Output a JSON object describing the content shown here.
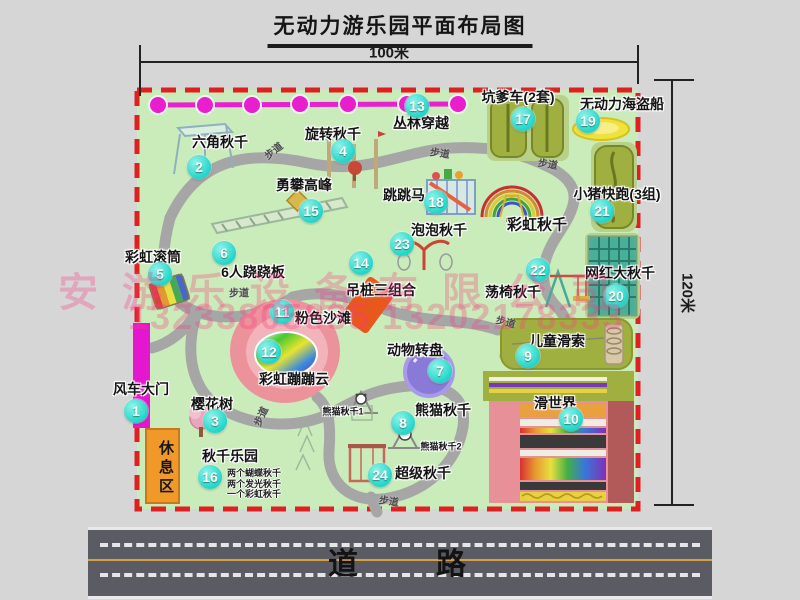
{
  "title": "无动力游乐园平面布局图",
  "dimensions": {
    "top": "100米",
    "right": "120米"
  },
  "road_label": "道　　路",
  "watermark": {
    "company": "安游乐设备有限公司",
    "phones": "13233805835 13202178333"
  },
  "rest_area_label": "休息区",
  "palette": {
    "map_green": "#c9ecba",
    "border_red": "#e02020",
    "path_gray": "#a6a6a6",
    "circle_teal": "#22d6c8",
    "gate_magenta": "#e417cf",
    "road_gray": "#5b5b63",
    "rest_orange": "#f09828",
    "watermark_pink": "#fa3c82"
  },
  "map": {
    "attractions": [
      {
        "num": "1",
        "label": "风车大门",
        "tx": 141,
        "ty": 389,
        "cx": 136,
        "cy": 411
      },
      {
        "num": "2",
        "label": "六角秋千",
        "tx": 220,
        "ty": 142,
        "cx": 199,
        "cy": 167
      },
      {
        "num": "3",
        "label": "樱花树",
        "tx": 212,
        "ty": 404,
        "cx": 215,
        "cy": 421
      },
      {
        "num": "4",
        "label": "旋转秋千",
        "tx": 333,
        "ty": 134,
        "cx": 343,
        "cy": 151
      },
      {
        "num": "5",
        "label": "彩虹滚筒",
        "tx": 153,
        "ty": 257,
        "cx": 160,
        "cy": 274
      },
      {
        "num": "6",
        "label": "6人跷跷板",
        "tx": 253,
        "ty": 272,
        "cx": 224,
        "cy": 253
      },
      {
        "num": "7",
        "label": "动物转盘",
        "tx": 415,
        "ty": 350,
        "cx": 440,
        "cy": 371
      },
      {
        "num": "8",
        "label": "熊猫秋千",
        "tx": 443,
        "ty": 410,
        "cx": 403,
        "cy": 423
      },
      {
        "num": "9",
        "label": "儿童滑索",
        "tx": 557,
        "ty": 341,
        "cx": 528,
        "cy": 356
      },
      {
        "num": "10",
        "label": "滑世界",
        "tx": 555,
        "ty": 403,
        "cx": 571,
        "cy": 419
      },
      {
        "num": "11",
        "label": "粉色沙滩",
        "tx": 323,
        "ty": 318,
        "cx": 282,
        "cy": 312
      },
      {
        "num": "12",
        "label": "彩虹蹦蹦云",
        "tx": 294,
        "ty": 379,
        "cx": 269,
        "cy": 352
      },
      {
        "num": "13",
        "label": "丛林穿越",
        "tx": 421,
        "ty": 123,
        "cx": 417,
        "cy": 106
      },
      {
        "num": "14",
        "label": "吊桩三组合",
        "tx": 381,
        "ty": 290,
        "cx": 361,
        "cy": 263
      },
      {
        "num": "15",
        "label": "勇攀高峰",
        "tx": 304,
        "ty": 185,
        "cx": 311,
        "cy": 211
      },
      {
        "num": "16",
        "label": "秋千乐园",
        "tx": 230,
        "ty": 456,
        "cx": 210,
        "cy": 477
      },
      {
        "num": "17",
        "label": "坑爹车(2套)",
        "tx": 518,
        "ty": 97,
        "cx": 523,
        "cy": 119
      },
      {
        "num": "18",
        "label": "跳跳马",
        "tx": 404,
        "ty": 195,
        "cx": 436,
        "cy": 202
      },
      {
        "num": "19",
        "label": "无动力海盗船",
        "tx": 622,
        "ty": 104,
        "cx": 588,
        "cy": 121
      },
      {
        "num": "20",
        "label": "网红大秋千",
        "tx": 620,
        "ty": 273,
        "cx": 616,
        "cy": 296
      },
      {
        "num": "21",
        "label": "小猪快跑(3组)",
        "tx": 617,
        "ty": 194,
        "cx": 602,
        "cy": 211
      },
      {
        "num": "22",
        "label": "荡椅秋千",
        "tx": 513,
        "ty": 292,
        "cx": 538,
        "cy": 270
      },
      {
        "num": "23",
        "label": "泡泡秋千",
        "tx": 439,
        "ty": 230,
        "cx": 402,
        "cy": 244
      },
      {
        "num": "24",
        "label": "超级秋千",
        "tx": 423,
        "ty": 473,
        "cx": 380,
        "cy": 475
      }
    ],
    "extra_labels": [
      {
        "text": "彩虹秋千",
        "x": 537,
        "y": 224,
        "fs": 15
      },
      {
        "text": "熊猫秋千1",
        "x": 343,
        "y": 411,
        "fs": 9
      },
      {
        "text": "熊猫秋千2",
        "x": 441,
        "y": 446,
        "fs": 9
      }
    ],
    "trail_labels": [
      {
        "text": "步道",
        "x": 273,
        "y": 150,
        "rot": -38
      },
      {
        "text": "步道",
        "x": 440,
        "y": 152,
        "rot": 8
      },
      {
        "text": "步道",
        "x": 548,
        "y": 163,
        "rot": 10
      },
      {
        "text": "步道",
        "x": 239,
        "y": 292,
        "rot": 0
      },
      {
        "text": "步道",
        "x": 506,
        "y": 321,
        "rot": 15
      },
      {
        "text": "步道",
        "x": 260,
        "y": 416,
        "rot": -65
      },
      {
        "text": "步道",
        "x": 389,
        "y": 500,
        "rot": 8
      }
    ],
    "swing_park_details": {
      "x": 227,
      "y": 468,
      "lines": [
        "两个蝴蝶秋千",
        "两个发光秋千",
        "一个彩虹秋千"
      ]
    }
  }
}
